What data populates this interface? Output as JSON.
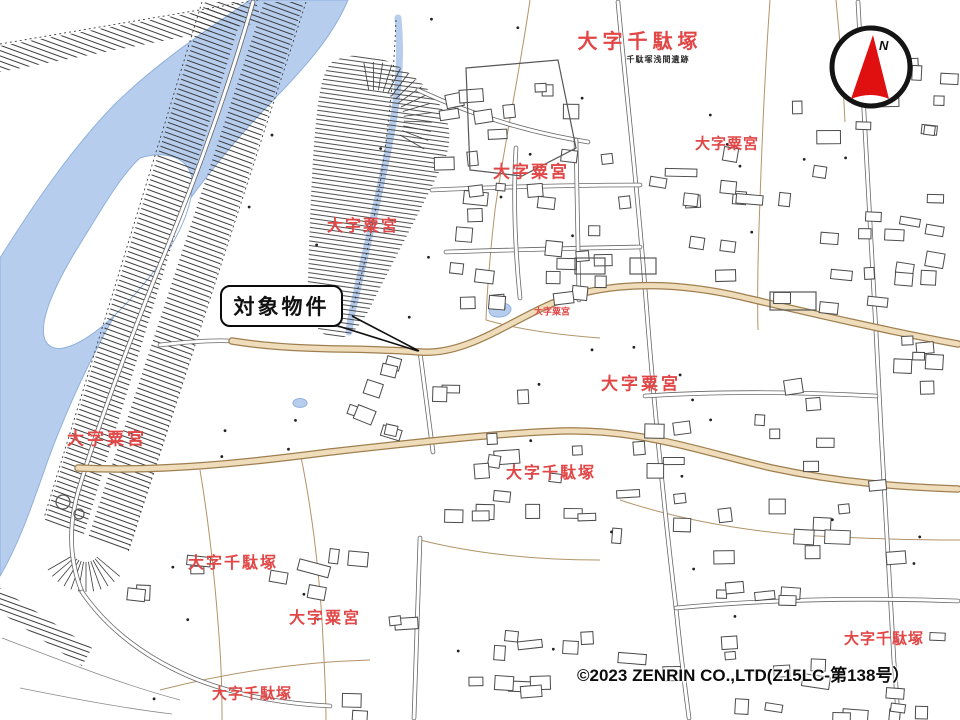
{
  "map": {
    "callout": {
      "label": "対象物件"
    },
    "compass": {
      "north_label": "N"
    },
    "copyright": "©2023 ZENRIN CO.,LTD(Z15LC-第138号）",
    "area_labels": [
      {
        "text": "大字千駄塚",
        "x": 640,
        "y": 42,
        "size": 20,
        "ls": 5,
        "color": "#e14747"
      },
      {
        "text": "千駄塚浅間遺跡",
        "x": 658,
        "y": 60,
        "size": 8,
        "ls": 1,
        "color": "#2a2a2a"
      },
      {
        "text": "大字粟宮",
        "x": 531,
        "y": 172,
        "size": 17,
        "ls": 2,
        "color": "#e14747"
      },
      {
        "text": "大字粟宮",
        "x": 727,
        "y": 144,
        "size": 15,
        "ls": 1,
        "color": "#e14747"
      },
      {
        "text": "大字粟宮",
        "x": 363,
        "y": 227,
        "size": 16,
        "ls": 2,
        "color": "#e14747"
      },
      {
        "text": "大字粟宮",
        "x": 552,
        "y": 312,
        "size": 9,
        "ls": 0,
        "color": "#e14747"
      },
      {
        "text": "大字粟宮",
        "x": 641,
        "y": 384,
        "size": 17,
        "ls": 3,
        "color": "#e14747"
      },
      {
        "text": "大字粟宮",
        "x": 107,
        "y": 439,
        "size": 17,
        "ls": 3,
        "color": "#e14747"
      },
      {
        "text": "大字千駄塚",
        "x": 551,
        "y": 474,
        "size": 16,
        "ls": 2,
        "color": "#e14747"
      },
      {
        "text": "大字千駄塚",
        "x": 233,
        "y": 564,
        "size": 16,
        "ls": 2,
        "color": "#e14747"
      },
      {
        "text": "大字粟宮",
        "x": 325,
        "y": 619,
        "size": 16,
        "ls": 2,
        "color": "#e14747"
      },
      {
        "text": "大字千駄塚",
        "x": 884,
        "y": 639,
        "size": 15,
        "ls": 1,
        "color": "#e14747"
      },
      {
        "text": "大字千駄塚",
        "x": 252,
        "y": 694,
        "size": 15,
        "ls": 1,
        "color": "#e14747"
      }
    ],
    "colors": {
      "water": "#b7cdee",
      "water_edge": "#8fb0dc",
      "label_red": "#e14747",
      "line_gray": "#5a5a5a",
      "parcel_brown": "#b29468",
      "road_tan_fill": "#eedcba",
      "road_tan_edge": "#9f7f4f",
      "compass_red": "#e01010"
    }
  }
}
